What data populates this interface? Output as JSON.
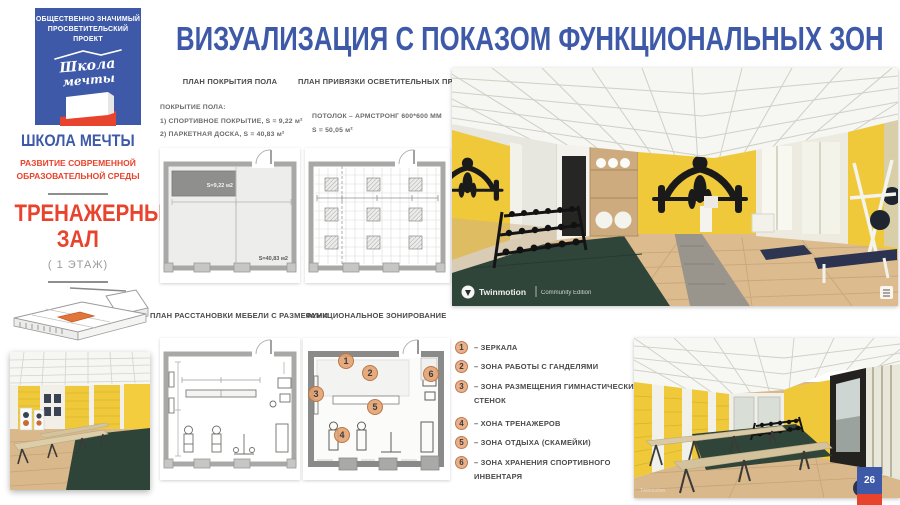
{
  "slide": {
    "title": "ВИЗУАЛИЗАЦИЯ С ПОКАЗОМ ФУНКЦИОНАЛЬНЫХ ЗОН",
    "page_number": "26"
  },
  "sidebar": {
    "logo_badge": {
      "top_line1": "ОБЩЕСТВЕННО ЗНАЧИМЫЙ",
      "top_line2": "ПРОСВЕТИТЕЛЬСКИЙ ПРОЕКТ",
      "script_line1": "Школа",
      "script_line2": "мечты"
    },
    "brand_title": "ШКОЛА МЕЧТЫ",
    "brand_subtitle_line1": "РАЗВИТИЕ СОВРЕМЕННОЙ",
    "brand_subtitle_line2": "ОБРАЗОВАТЕЛЬНОЙ СРЕДЫ",
    "room_line1": "ТРЕНАЖЕРНЫЙ",
    "room_line2": "ЗАЛ",
    "floor_label": "( 1 ЭТАЖ)"
  },
  "plans": {
    "floor_cover": {
      "title": "ПЛАН ПОКРЫТИЯ ПОЛА",
      "note_heading": "ПОКРЫТИЕ ПОЛА:",
      "note_line1": "1) СПОРТИВНОЕ ПОКРЫТИЕ,  S = 9,22 м²",
      "note_line2": "2) ПАРКЕТНАЯ ДОСКА,  S = 40,83 м²",
      "area_sport": "S=9,22 м2",
      "area_parquet": "S=40,83 м2"
    },
    "lighting": {
      "title": "ПЛАН ПРИВЯЗКИ ОСВЕТИТЕЛЬНЫХ ПРИБОРОВ",
      "note_line1": "ПОТОЛОК – АРМСТРОНГ 600*600 ММ",
      "note_line2": "S = 50,05 м²"
    },
    "furniture": {
      "title": "ПЛАН РАССТАНОВКИ МЕБЕЛИ С РАЗМЕРАМИ"
    },
    "zoning": {
      "title": "ФУНКЦИОНАЛЬНОЕ ЗОНИРОВАНИЕ"
    }
  },
  "legend": {
    "items": [
      {
        "num": "1",
        "label": "– ЗЕРКАЛА"
      },
      {
        "num": "2",
        "label": "– ЗОНА РАБОТЫ С ГАНДЕЛЯМИ"
      },
      {
        "num": "3",
        "label": "– ЗОНА РАЗМЕЩЕНИЯ ГИМНАСТИЧЕСКИХ СТЕНОК"
      },
      {
        "num": "4",
        "label": "– ХОНА ТРЕНАЖЕРОВ"
      },
      {
        "num": "5",
        "label": "– ЗОНА ОТДЫХА (СКАМЕЙКИ)"
      },
      {
        "num": "6",
        "label": "– ЗОНА ХРАНЕНИЯ СПОРТИВНОГО ИНВЕНТАРЯ"
      }
    ]
  },
  "renders": {
    "watermark_brand": "Twinmotion",
    "watermark_edition": "Community Edition"
  },
  "colors": {
    "brand_blue": "#3d59a7",
    "brand_red": "#e8432c",
    "zone_marker_orange": "#e2a479",
    "wall_yellow": "#f0c93a",
    "carpet_green": "#30453a",
    "floor_wood": "#d9b88c"
  }
}
